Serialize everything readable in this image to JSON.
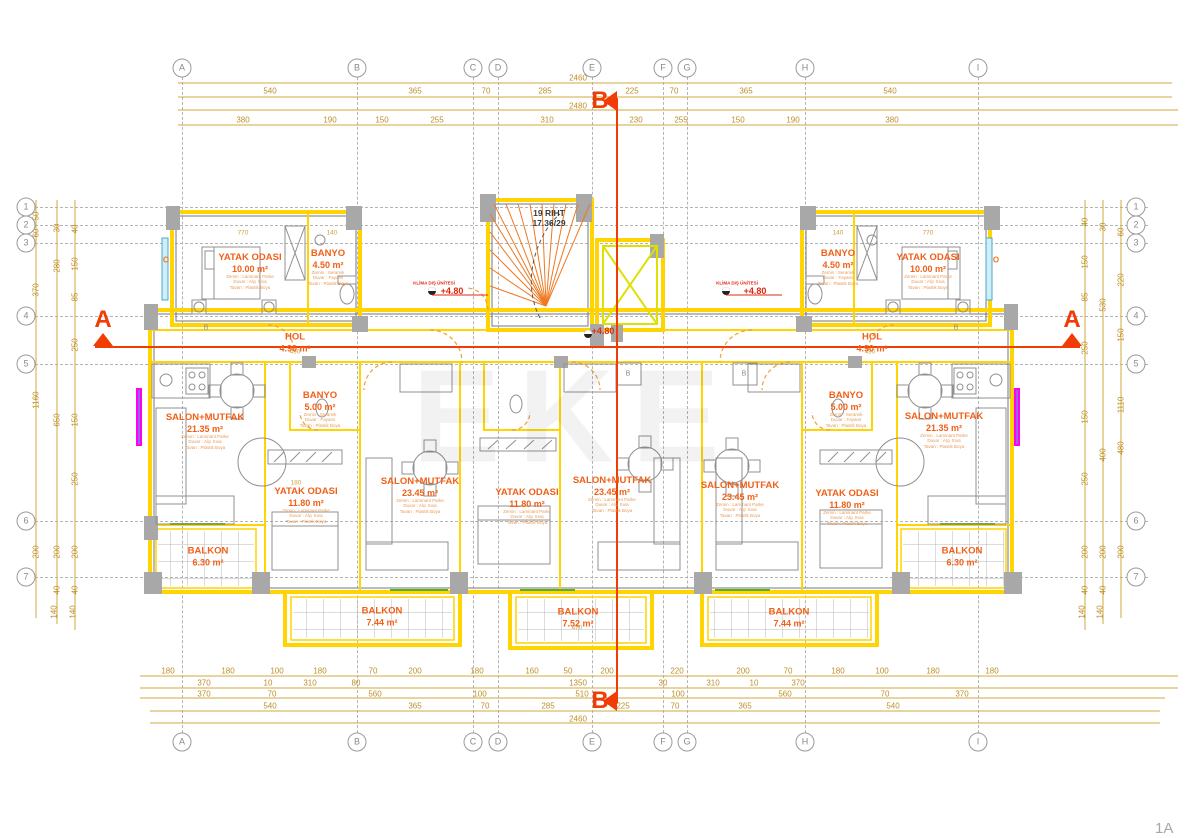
{
  "meta": {
    "watermark": "EKE",
    "sheet_label": "1A"
  },
  "section": {
    "a": "A",
    "b": "B"
  },
  "stair": {
    "line1": "19 RIHT",
    "line2": "17.36/29"
  },
  "finishes": {
    "apt": [
      "Zemin : Laminant Parke",
      "Duvar : Alçı Sıva",
      "Tavan : Plastik Boya"
    ],
    "wet": [
      "Zemin : Seramik",
      "Duvar : Fayans",
      "Tavan : Plastik Boya"
    ]
  },
  "grid": {
    "cols": [
      {
        "label": "A",
        "x": 182
      },
      {
        "label": "B",
        "x": 357
      },
      {
        "label": "C",
        "x": 473
      },
      {
        "label": "D",
        "x": 498
      },
      {
        "label": "E",
        "x": 592
      },
      {
        "label": "F",
        "x": 663
      },
      {
        "label": "G",
        "x": 687
      },
      {
        "label": "H",
        "x": 805
      },
      {
        "label": "I",
        "x": 978
      }
    ],
    "rows": [
      {
        "label": "1",
        "y": 207
      },
      {
        "label": "2",
        "y": 225
      },
      {
        "label": "3",
        "y": 243
      },
      {
        "label": "4",
        "y": 316
      },
      {
        "label": "5",
        "y": 364
      },
      {
        "label": "6",
        "y": 521
      },
      {
        "label": "7",
        "y": 577
      }
    ]
  },
  "rooms": [
    {
      "name": "YATAK ODASI",
      "area": "10.00 m²",
      "x": 250,
      "y": 272,
      "fin": "apt"
    },
    {
      "name": "BANYO",
      "area": "4.50 m²",
      "x": 328,
      "y": 268,
      "fin": "wet"
    },
    {
      "name": "HOL",
      "area": "4.90 m²",
      "x": 295,
      "y": 343,
      "fin": null
    },
    {
      "name": "BANYO",
      "area": "4.50 m²",
      "x": 838,
      "y": 268,
      "fin": "wet"
    },
    {
      "name": "YATAK ODASI",
      "area": "10.00 m²",
      "x": 928,
      "y": 272,
      "fin": "apt"
    },
    {
      "name": "HOL",
      "area": "4.90 m²",
      "x": 872,
      "y": 343,
      "fin": null
    },
    {
      "name": "SALON+MUTFAK",
      "area": "21.35 m²",
      "x": 205,
      "y": 432,
      "fin": "apt"
    },
    {
      "name": "BANYO",
      "area": "5.00 m²",
      "x": 320,
      "y": 410,
      "fin": "wet"
    },
    {
      "name": "YATAK ODASI",
      "area": "11.80 m²",
      "x": 306,
      "y": 506,
      "fin": "apt"
    },
    {
      "name": "SALON+MUTFAK",
      "area": "23.45 m²",
      "x": 420,
      "y": 496,
      "fin": "apt"
    },
    {
      "name": "YATAK ODASI",
      "area": "11.80 m²",
      "x": 527,
      "y": 507,
      "fin": "apt"
    },
    {
      "name": "SALON+MUTFAK",
      "area": "23.45 m²",
      "x": 612,
      "y": 495,
      "fin": "apt"
    },
    {
      "name": "SALON+MUTFAK",
      "area": "23.45 m²",
      "x": 740,
      "y": 500,
      "fin": "apt"
    },
    {
      "name": "YATAK ODASI",
      "area": "11.80 m²",
      "x": 847,
      "y": 508,
      "fin": "apt"
    },
    {
      "name": "BANYO",
      "area": "5.00 m²",
      "x": 846,
      "y": 410,
      "fin": "wet"
    },
    {
      "name": "SALON+MUTFAK",
      "area": "21.35 m²",
      "x": 944,
      "y": 431,
      "fin": "apt"
    },
    {
      "name": "BALKON",
      "area": "6.30 m²",
      "x": 208,
      "y": 557,
      "fin": null
    },
    {
      "name": "BALKON",
      "area": "6.30 m²",
      "x": 962,
      "y": 557,
      "fin": null
    },
    {
      "name": "BALKON",
      "area": "7.44 m²",
      "x": 382,
      "y": 617,
      "fin": null
    },
    {
      "name": "BALKON",
      "area": "7.52 m²",
      "x": 578,
      "y": 618,
      "fin": null
    },
    {
      "name": "BALKON",
      "area": "7.44 m²",
      "x": 789,
      "y": 618,
      "fin": null
    }
  ],
  "annotations": [
    {
      "t": "2460",
      "x": 578,
      "y": 78,
      "c": "dim"
    },
    {
      "t": "540",
      "x": 270,
      "y": 91,
      "c": "dim"
    },
    {
      "t": "365",
      "x": 415,
      "y": 91,
      "c": "dim"
    },
    {
      "t": "70",
      "x": 486,
      "y": 91,
      "c": "dim"
    },
    {
      "t": "285",
      "x": 545,
      "y": 91,
      "c": "dim"
    },
    {
      "t": "225",
      "x": 632,
      "y": 91,
      "c": "dim"
    },
    {
      "t": "70",
      "x": 674,
      "y": 91,
      "c": "dim"
    },
    {
      "t": "365",
      "x": 746,
      "y": 91,
      "c": "dim"
    },
    {
      "t": "540",
      "x": 890,
      "y": 91,
      "c": "dim"
    },
    {
      "t": "2480",
      "x": 578,
      "y": 106,
      "c": "dim"
    },
    {
      "t": "380",
      "x": 243,
      "y": 120,
      "c": "dim"
    },
    {
      "t": "190",
      "x": 330,
      "y": 120,
      "c": "dim"
    },
    {
      "t": "150",
      "x": 382,
      "y": 120,
      "c": "dim"
    },
    {
      "t": "255",
      "x": 437,
      "y": 120,
      "c": "dim"
    },
    {
      "t": "310",
      "x": 547,
      "y": 120,
      "c": "dim"
    },
    {
      "t": "230",
      "x": 636,
      "y": 120,
      "c": "dim"
    },
    {
      "t": "255",
      "x": 681,
      "y": 120,
      "c": "dim"
    },
    {
      "t": "150",
      "x": 738,
      "y": 120,
      "c": "dim"
    },
    {
      "t": "190",
      "x": 793,
      "y": 120,
      "c": "dim"
    },
    {
      "t": "380",
      "x": 892,
      "y": 120,
      "c": "dim"
    },
    {
      "t": "180",
      "x": 168,
      "y": 671,
      "c": "dim"
    },
    {
      "t": "180",
      "x": 228,
      "y": 671,
      "c": "dim"
    },
    {
      "t": "100",
      "x": 277,
      "y": 671,
      "c": "dim"
    },
    {
      "t": "180",
      "x": 320,
      "y": 671,
      "c": "dim"
    },
    {
      "t": "70",
      "x": 373,
      "y": 671,
      "c": "dim"
    },
    {
      "t": "200",
      "x": 415,
      "y": 671,
      "c": "dim"
    },
    {
      "t": "180",
      "x": 477,
      "y": 671,
      "c": "dim"
    },
    {
      "t": "160",
      "x": 532,
      "y": 671,
      "c": "dim"
    },
    {
      "t": "50",
      "x": 568,
      "y": 671,
      "c": "dim"
    },
    {
      "t": "200",
      "x": 607,
      "y": 671,
      "c": "dim"
    },
    {
      "t": "220",
      "x": 677,
      "y": 671,
      "c": "dim"
    },
    {
      "t": "200",
      "x": 743,
      "y": 671,
      "c": "dim"
    },
    {
      "t": "70",
      "x": 788,
      "y": 671,
      "c": "dim"
    },
    {
      "t": "180",
      "x": 838,
      "y": 671,
      "c": "dim"
    },
    {
      "t": "100",
      "x": 882,
      "y": 671,
      "c": "dim"
    },
    {
      "t": "180",
      "x": 933,
      "y": 671,
      "c": "dim"
    },
    {
      "t": "180",
      "x": 992,
      "y": 671,
      "c": "dim"
    },
    {
      "t": "370",
      "x": 204,
      "y": 683,
      "c": "dim"
    },
    {
      "t": "10",
      "x": 268,
      "y": 683,
      "c": "dim"
    },
    {
      "t": "310",
      "x": 310,
      "y": 683,
      "c": "dim"
    },
    {
      "t": "80",
      "x": 356,
      "y": 683,
      "c": "dim"
    },
    {
      "t": "1350",
      "x": 578,
      "y": 683,
      "c": "dim"
    },
    {
      "t": "30",
      "x": 663,
      "y": 683,
      "c": "dim"
    },
    {
      "t": "310",
      "x": 713,
      "y": 683,
      "c": "dim"
    },
    {
      "t": "10",
      "x": 754,
      "y": 683,
      "c": "dim"
    },
    {
      "t": "370",
      "x": 798,
      "y": 683,
      "c": "dim"
    },
    {
      "t": "370",
      "x": 204,
      "y": 694,
      "c": "dim"
    },
    {
      "t": "70",
      "x": 272,
      "y": 694,
      "c": "dim"
    },
    {
      "t": "560",
      "x": 375,
      "y": 694,
      "c": "dim"
    },
    {
      "t": "100",
      "x": 480,
      "y": 694,
      "c": "dim"
    },
    {
      "t": "510",
      "x": 582,
      "y": 694,
      "c": "dim"
    },
    {
      "t": "100",
      "x": 678,
      "y": 694,
      "c": "dim"
    },
    {
      "t": "560",
      "x": 785,
      "y": 694,
      "c": "dim"
    },
    {
      "t": "70",
      "x": 885,
      "y": 694,
      "c": "dim"
    },
    {
      "t": "370",
      "x": 962,
      "y": 694,
      "c": "dim"
    },
    {
      "t": "540",
      "x": 270,
      "y": 706,
      "c": "dim"
    },
    {
      "t": "365",
      "x": 415,
      "y": 706,
      "c": "dim"
    },
    {
      "t": "70",
      "x": 485,
      "y": 706,
      "c": "dim"
    },
    {
      "t": "285",
      "x": 548,
      "y": 706,
      "c": "dim"
    },
    {
      "t": "225",
      "x": 623,
      "y": 706,
      "c": "dim"
    },
    {
      "t": "70",
      "x": 675,
      "y": 706,
      "c": "dim"
    },
    {
      "t": "365",
      "x": 745,
      "y": 706,
      "c": "dim"
    },
    {
      "t": "540",
      "x": 893,
      "y": 706,
      "c": "dim"
    },
    {
      "t": "2460",
      "x": 578,
      "y": 719,
      "c": "dim"
    },
    {
      "t": "50",
      "x": 36,
      "y": 216,
      "c": "dimv"
    },
    {
      "t": "60",
      "x": 36,
      "y": 233,
      "c": "dimv"
    },
    {
      "t": "370",
      "x": 36,
      "y": 290,
      "c": "dimv"
    },
    {
      "t": "1160",
      "x": 36,
      "y": 400,
      "c": "dimv"
    },
    {
      "t": "200",
      "x": 36,
      "y": 552,
      "c": "dimv"
    },
    {
      "t": "30",
      "x": 57,
      "y": 228,
      "c": "dimv"
    },
    {
      "t": "280",
      "x": 57,
      "y": 266,
      "c": "dimv"
    },
    {
      "t": "650",
      "x": 57,
      "y": 420,
      "c": "dimv"
    },
    {
      "t": "200",
      "x": 57,
      "y": 552,
      "c": "dimv"
    },
    {
      "t": "40",
      "x": 57,
      "y": 590,
      "c": "dimv"
    },
    {
      "t": "140",
      "x": 54,
      "y": 612,
      "c": "dimv"
    },
    {
      "t": "40",
      "x": 75,
      "y": 229,
      "c": "dimv"
    },
    {
      "t": "150",
      "x": 75,
      "y": 264,
      "c": "dimv"
    },
    {
      "t": "85",
      "x": 75,
      "y": 297,
      "c": "dimv"
    },
    {
      "t": "250",
      "x": 75,
      "y": 345,
      "c": "dimv"
    },
    {
      "t": "150",
      "x": 75,
      "y": 420,
      "c": "dimv"
    },
    {
      "t": "250",
      "x": 75,
      "y": 479,
      "c": "dimv"
    },
    {
      "t": "200",
      "x": 75,
      "y": 552,
      "c": "dimv"
    },
    {
      "t": "40",
      "x": 75,
      "y": 590,
      "c": "dimv"
    },
    {
      "t": "140",
      "x": 73,
      "y": 612,
      "c": "dimv"
    },
    {
      "t": "40",
      "x": 1085,
      "y": 222,
      "c": "dimv"
    },
    {
      "t": "150",
      "x": 1085,
      "y": 262,
      "c": "dimv"
    },
    {
      "t": "85",
      "x": 1085,
      "y": 297,
      "c": "dimv"
    },
    {
      "t": "250",
      "x": 1085,
      "y": 348,
      "c": "dimv"
    },
    {
      "t": "150",
      "x": 1085,
      "y": 417,
      "c": "dimv"
    },
    {
      "t": "250",
      "x": 1085,
      "y": 479,
      "c": "dimv"
    },
    {
      "t": "200",
      "x": 1085,
      "y": 552,
      "c": "dimv"
    },
    {
      "t": "40",
      "x": 1085,
      "y": 590,
      "c": "dimv"
    },
    {
      "t": "140",
      "x": 1082,
      "y": 612,
      "c": "dimv"
    },
    {
      "t": "30",
      "x": 1103,
      "y": 227,
      "c": "dimv"
    },
    {
      "t": "530",
      "x": 1103,
      "y": 305,
      "c": "dimv"
    },
    {
      "t": "400",
      "x": 1103,
      "y": 455,
      "c": "dimv"
    },
    {
      "t": "200",
      "x": 1103,
      "y": 552,
      "c": "dimv"
    },
    {
      "t": "40",
      "x": 1103,
      "y": 590,
      "c": "dimv"
    },
    {
      "t": "140",
      "x": 1100,
      "y": 612,
      "c": "dimv"
    },
    {
      "t": "60",
      "x": 1121,
      "y": 232,
      "c": "dimv"
    },
    {
      "t": "220",
      "x": 1121,
      "y": 280,
      "c": "dimv"
    },
    {
      "t": "150",
      "x": 1121,
      "y": 335,
      "c": "dimv"
    },
    {
      "t": "1110",
      "x": 1121,
      "y": 405,
      "c": "dimv"
    },
    {
      "t": "480",
      "x": 1121,
      "y": 448,
      "c": "dimv"
    },
    {
      "t": "200",
      "x": 1121,
      "y": 552,
      "c": "dimv"
    },
    {
      "t": "B",
      "x": 206,
      "y": 328,
      "c": "tag"
    },
    {
      "t": "B",
      "x": 956,
      "y": 328,
      "c": "tag"
    },
    {
      "t": "B",
      "x": 628,
      "y": 374,
      "c": "tag"
    },
    {
      "t": "B",
      "x": 744,
      "y": 374,
      "c": "tag"
    },
    {
      "t": "O",
      "x": 166,
      "y": 260,
      "c": "tago"
    },
    {
      "t": "O",
      "x": 996,
      "y": 260,
      "c": "tago"
    },
    {
      "t": "KLİMA DIŞ ÜNİTESİ",
      "x": 434,
      "y": 283,
      "c": "klima"
    },
    {
      "t": "+4.80",
      "x": 452,
      "y": 291,
      "c": "lvl"
    },
    {
      "t": "KLİMA DIŞ ÜNİTESİ",
      "x": 737,
      "y": 283,
      "c": "klima"
    },
    {
      "t": "+4.80",
      "x": 755,
      "y": 291,
      "c": "lvl"
    },
    {
      "t": "+4.80",
      "x": 603,
      "y": 331,
      "c": "lvl"
    },
    {
      "t": "770",
      "x": 243,
      "y": 233,
      "c": "inner"
    },
    {
      "t": "140",
      "x": 332,
      "y": 233,
      "c": "inner"
    },
    {
      "t": "490",
      "x": 295,
      "y": 352,
      "c": "inner"
    },
    {
      "t": "770",
      "x": 928,
      "y": 233,
      "c": "inner"
    },
    {
      "t": "140",
      "x": 838,
      "y": 233,
      "c": "inner"
    },
    {
      "t": "490",
      "x": 870,
      "y": 352,
      "c": "inner"
    },
    {
      "t": "470",
      "x": 577,
      "y": 628,
      "c": "inner"
    },
    {
      "t": "180",
      "x": 296,
      "y": 483,
      "c": "inner"
    }
  ],
  "colors": {
    "wall": "#ffd400",
    "dims": "#bd8f2a",
    "label": "#f06018",
    "section": "#f23c05",
    "window_magenta": "#ff00f0",
    "window_cyan": "#48a8c8",
    "balcony_green": "#58b030"
  }
}
